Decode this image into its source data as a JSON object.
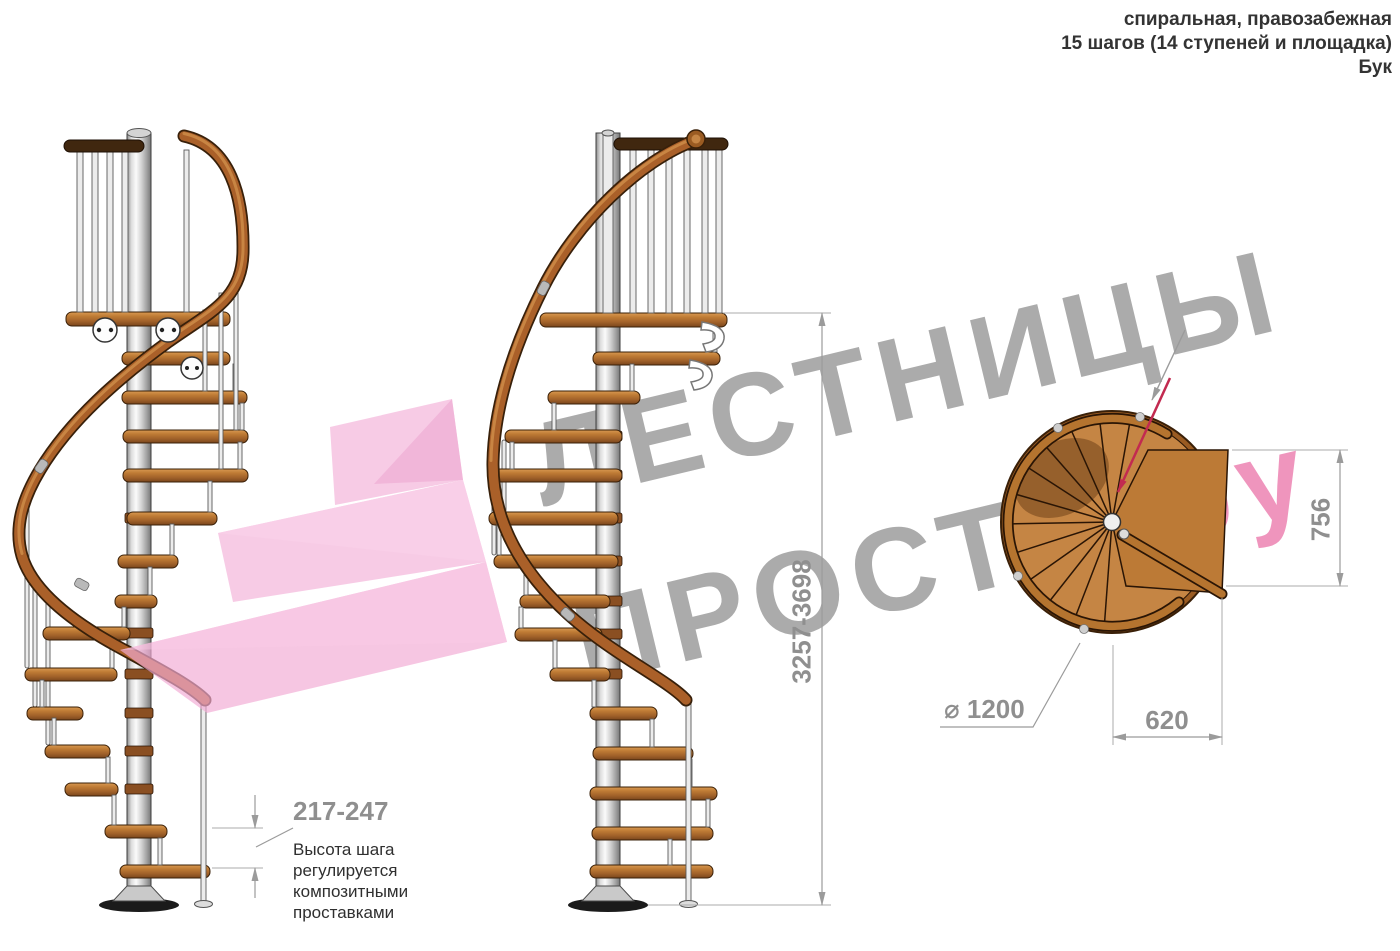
{
  "header": {
    "line1": "спиральная, правозабежная",
    "line2": "15 шагов (14 ступеней и площадка)",
    "line3": "Бук"
  },
  "watermark": {
    "line1": "ЛЕСТНИЦЫ",
    "line2": "ПРОСТО",
    "suffix": ".ру"
  },
  "dimensions": {
    "total_height": "3257-3698",
    "step_height": "217-247",
    "platform_depth": "756",
    "platform_width": "620",
    "diameter": "⌀ 1200"
  },
  "annotation": {
    "text": "Высота шага\nрегулируется\nкомпозитными\nпроставками"
  },
  "colors": {
    "watermark_gray": "#969696",
    "watermark_pink": "#ec82b2",
    "wood": "#aa6029",
    "dimension_gray": "#8f8f8f",
    "direction_arrow_red": "#c22a50"
  }
}
